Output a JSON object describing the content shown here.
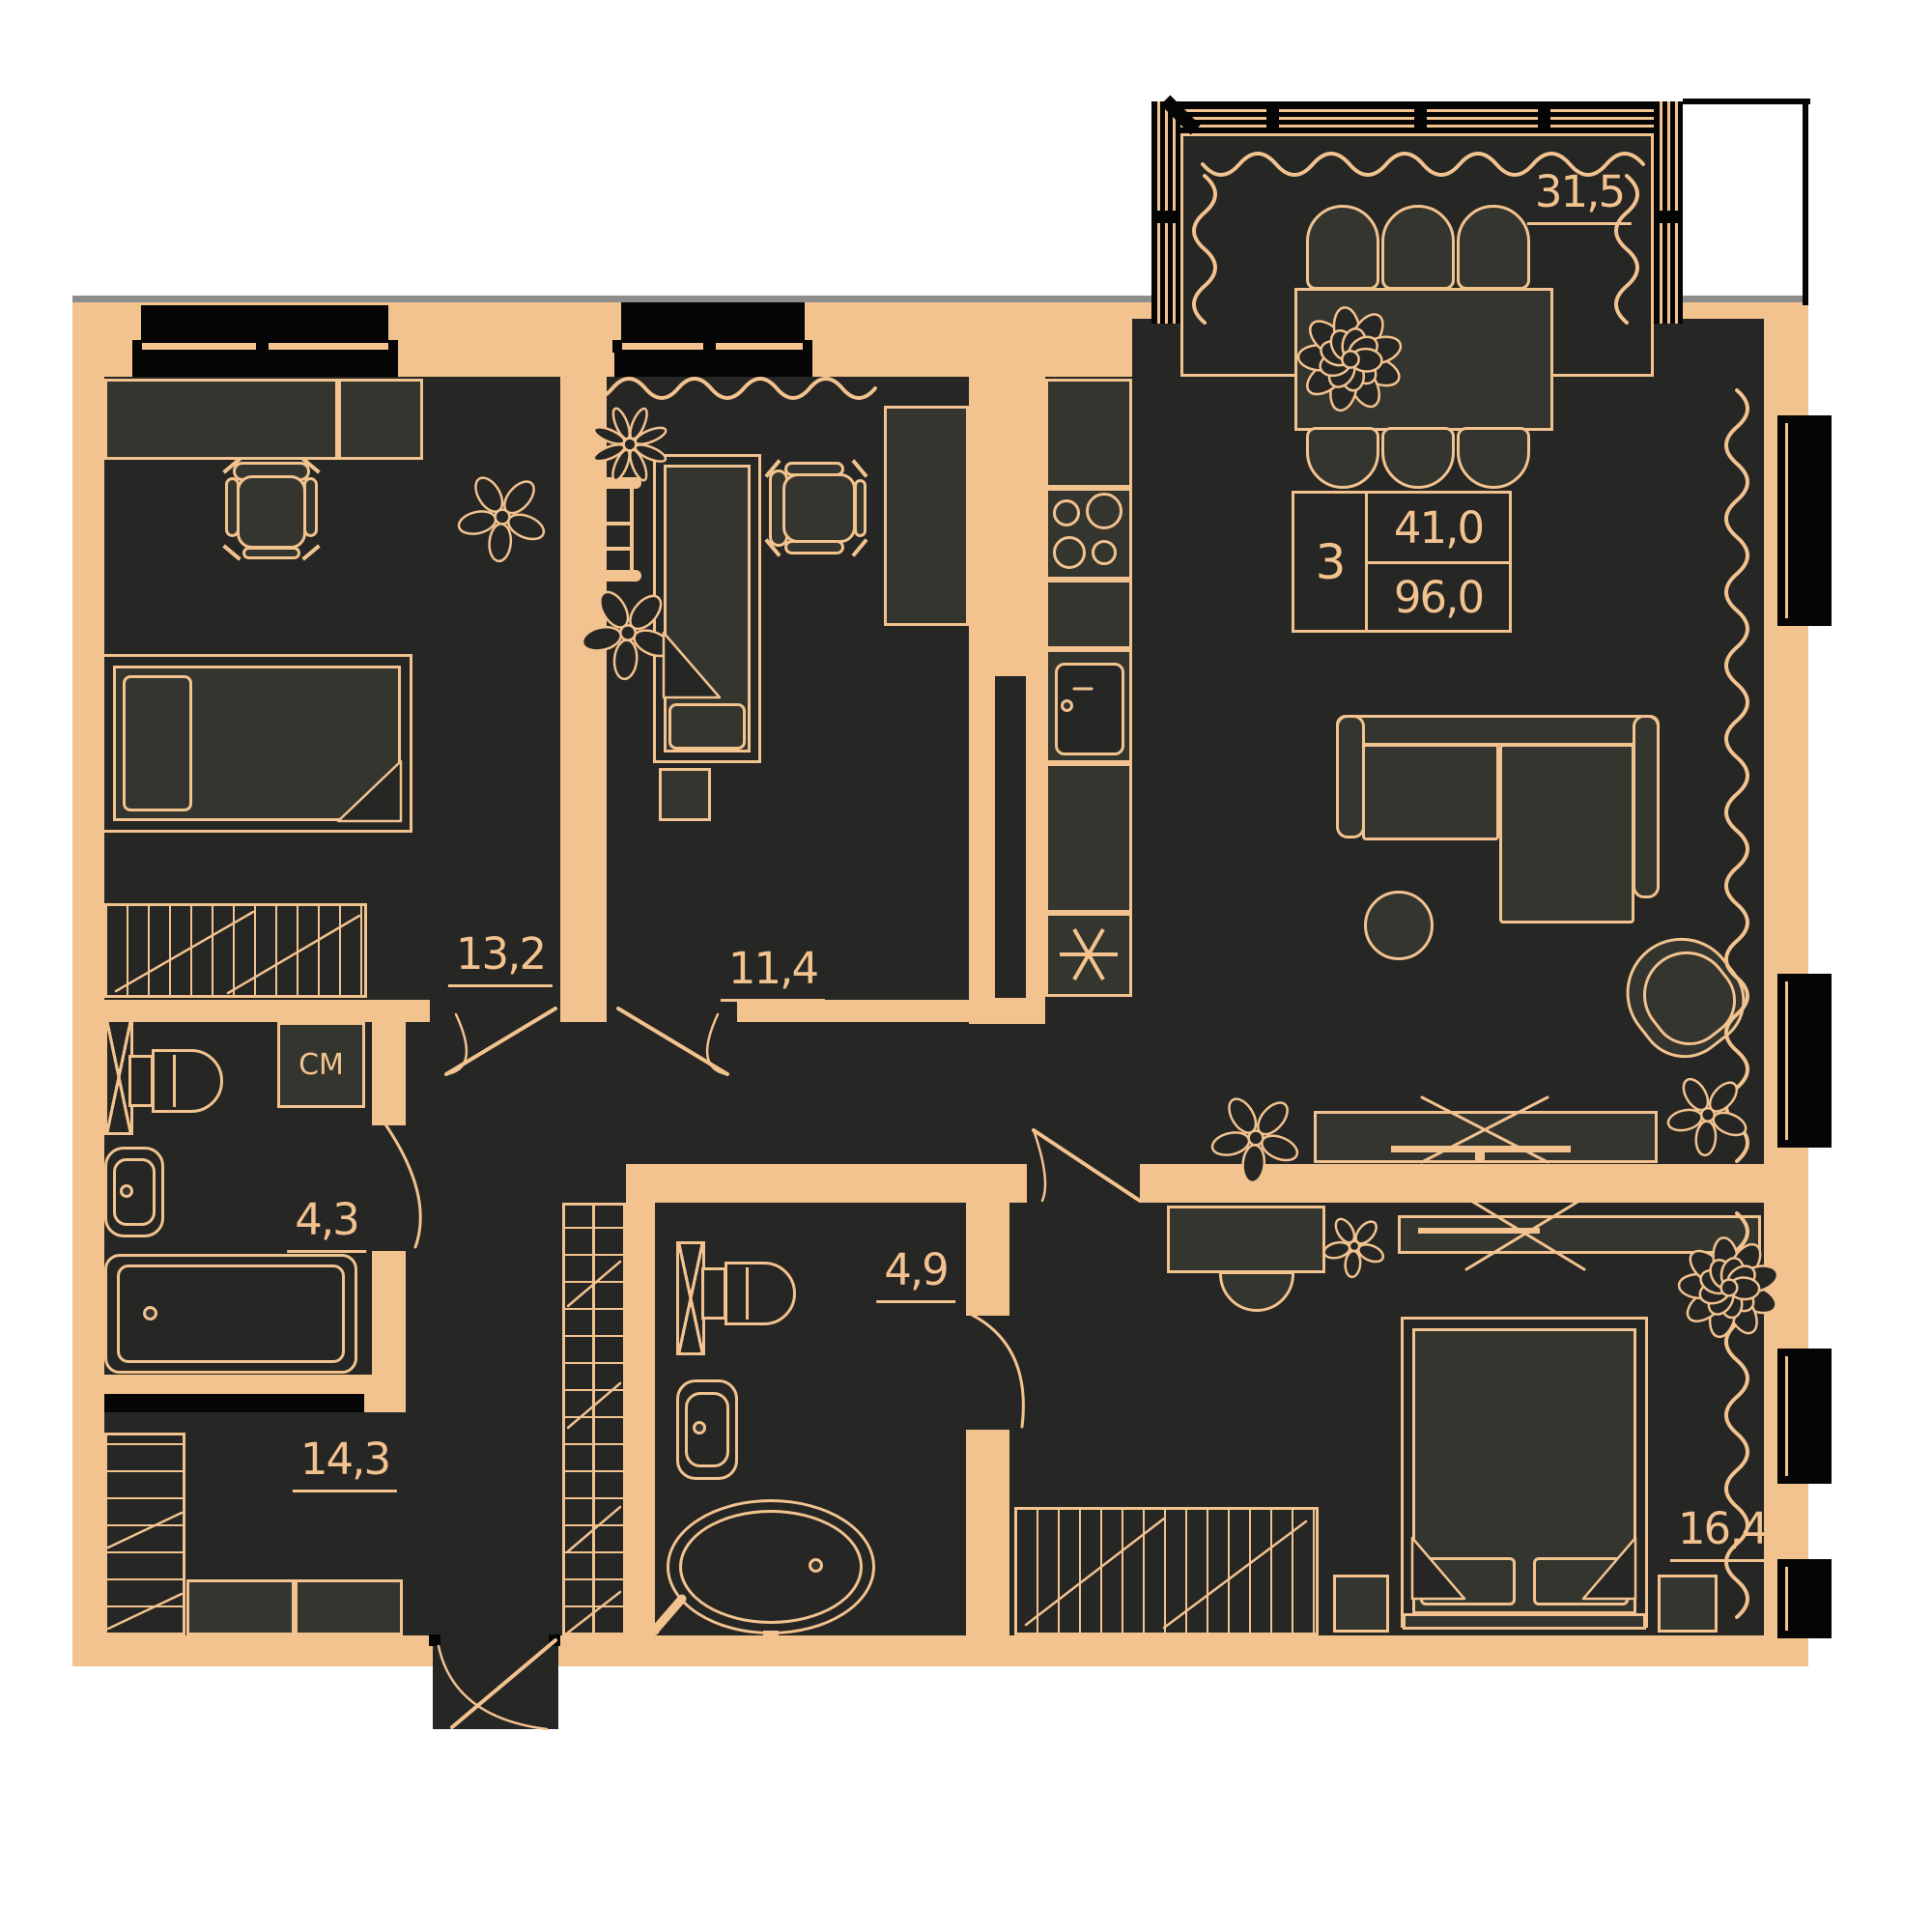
{
  "info_box": {
    "rooms_count": "3",
    "living_area": "41,0",
    "total_area": "96,0"
  },
  "rooms": {
    "living_kitchen": {
      "area": "31,5"
    },
    "bedroom_top_left": {
      "area": "13,2"
    },
    "bedroom_middle": {
      "area": "11,4"
    },
    "bathroom_small": {
      "area": "4,3"
    },
    "bathroom_large": {
      "area": "4,9"
    },
    "hallway": {
      "area": "14,3"
    },
    "bedroom_master": {
      "area": "16,4"
    }
  },
  "labels": {
    "washing_machine": "СМ"
  },
  "colors": {
    "wall": "#F2C28F",
    "room": "#262624",
    "furniture": "#35352F",
    "line": "#F2C28F",
    "black": "#050505",
    "background": "#FFFFFF"
  }
}
